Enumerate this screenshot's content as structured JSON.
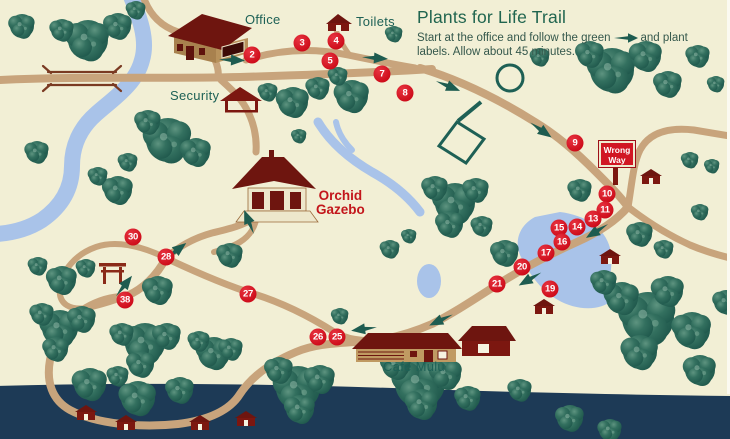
{
  "title": "Plants for Life Trail",
  "instructions": {
    "before_arrow": "Start at the office and follow the green",
    "after_arrow": "and plant labels.  Allow about 45 minutes."
  },
  "labels": {
    "office": "Office",
    "toilets": "Toilets",
    "security": "Security",
    "gazebo_line1": "Orchid",
    "gazebo_line2": "Gazebo",
    "cafe": "Cafe Mulu",
    "wrong_way_line1": "Wrong",
    "wrong_way_line2": "Way"
  },
  "markers": [
    {
      "n": "2",
      "x": 252,
      "y": 55
    },
    {
      "n": "3",
      "x": 302,
      "y": 43
    },
    {
      "n": "4",
      "x": 336,
      "y": 41
    },
    {
      "n": "5",
      "x": 330,
      "y": 61
    },
    {
      "n": "7",
      "x": 382,
      "y": 74
    },
    {
      "n": "8",
      "x": 405,
      "y": 93
    },
    {
      "n": "9",
      "x": 575,
      "y": 143
    },
    {
      "n": "10",
      "x": 607,
      "y": 194
    },
    {
      "n": "11",
      "x": 605,
      "y": 210
    },
    {
      "n": "13",
      "x": 593,
      "y": 219
    },
    {
      "n": "14",
      "x": 577,
      "y": 227
    },
    {
      "n": "15",
      "x": 559,
      "y": 228
    },
    {
      "n": "16",
      "x": 562,
      "y": 242
    },
    {
      "n": "17",
      "x": 546,
      "y": 253
    },
    {
      "n": "19",
      "x": 550,
      "y": 289
    },
    {
      "n": "20",
      "x": 522,
      "y": 267
    },
    {
      "n": "21",
      "x": 497,
      "y": 284
    },
    {
      "n": "25",
      "x": 337,
      "y": 337
    },
    {
      "n": "26",
      "x": 318,
      "y": 337
    },
    {
      "n": "27",
      "x": 248,
      "y": 294
    },
    {
      "n": "28",
      "x": 166,
      "y": 257
    },
    {
      "n": "30",
      "x": 133,
      "y": 237
    },
    {
      "n": "38",
      "x": 125,
      "y": 300
    }
  ],
  "colors": {
    "background": "#F2EFD5",
    "tree": "#2E6A5C",
    "path_tan": "#C8A47C",
    "river_blue": "#A9C3E9",
    "sea_navy": "#1D3A56",
    "marker_red": "#D2101E",
    "label_teal": "#1E6156",
    "gazebo_red": "#C3161B",
    "sign_red": "#D11623",
    "arrow_green": "#1E5C50",
    "building_maroon": "#7C1710"
  }
}
